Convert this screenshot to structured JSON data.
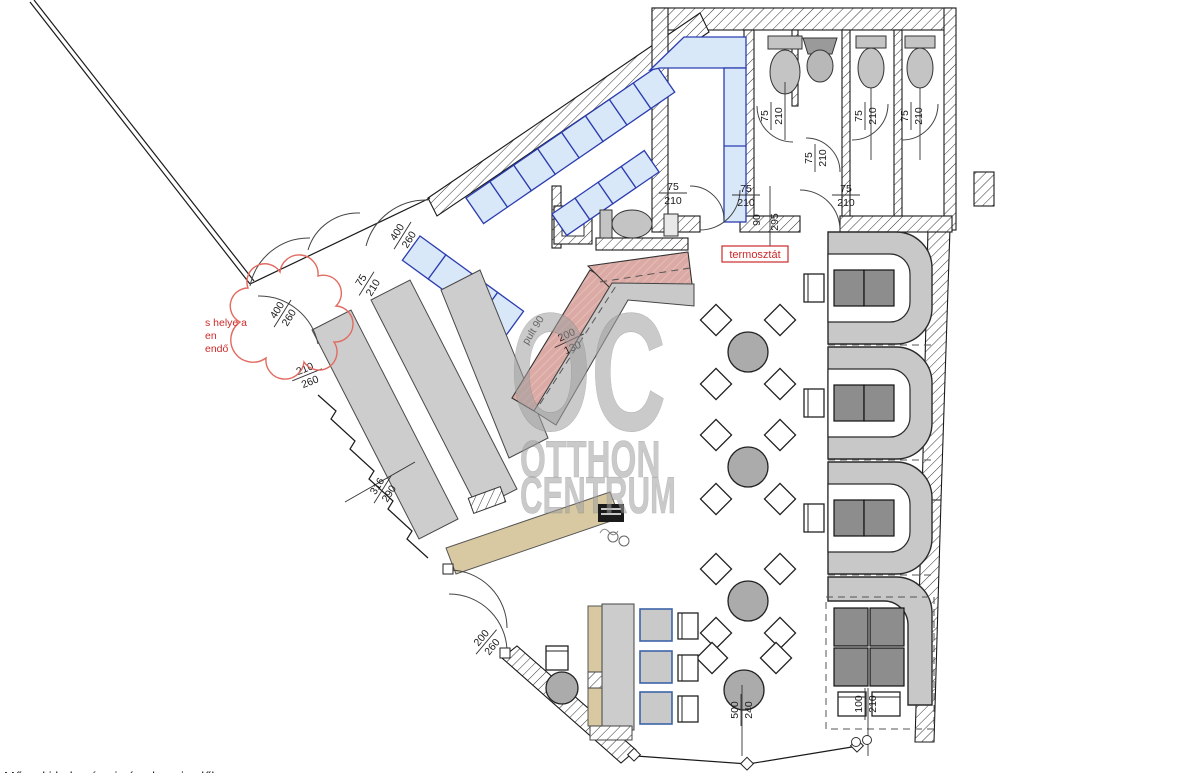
{
  "watermark": {
    "logo": "OC",
    "line1": "OTTHON",
    "line2": "CENTRUM"
  },
  "annotations": {
    "thermostat": "termosztát",
    "red_note_line1": "s helye a",
    "red_note_line2": "en",
    "red_note_line3": "endő",
    "counter_label": "pult 90",
    "bottom_caption": "Műszaki helyszínrajz és alaprajz előlap"
  },
  "dimensions": {
    "doors": [
      {
        "w": "75",
        "h": "210"
      },
      {
        "w": "75",
        "h": "210"
      },
      {
        "w": "75",
        "h": "210"
      },
      {
        "w": "75",
        "h": "210"
      },
      {
        "w": "75",
        "h": "210"
      },
      {
        "w": "75",
        "h": "210"
      },
      {
        "w": "75",
        "h": "210"
      },
      {
        "w": "75",
        "h": "210"
      }
    ],
    "corridor_depth": "90",
    "corridor_length": "295",
    "entry_top": {
      "a": "400",
      "b": "260"
    },
    "entry_left": {
      "a": "400",
      "b": "260"
    },
    "entry_left2": {
      "a": "210",
      "b": "260"
    },
    "shopfront": {
      "a": "316",
      "b": "290"
    },
    "bar": {
      "a": "200",
      "b": "130"
    },
    "door_bottom": {
      "a": "200",
      "b": "260"
    },
    "bottom_left": {
      "a": "500",
      "b": "240"
    },
    "bottom_right": {
      "a": "100",
      "b": "210"
    }
  },
  "colors": {
    "bench": "#d9e8f8",
    "bench_border": "#2b3db0",
    "booth": "#c8c8c8",
    "table_dark": "#8d8d8d",
    "counter_pink": "#dcaaa5",
    "counter_tan": "#d8c9a2",
    "red": "#cc2a2a",
    "watermark": "#a0a0a0"
  }
}
